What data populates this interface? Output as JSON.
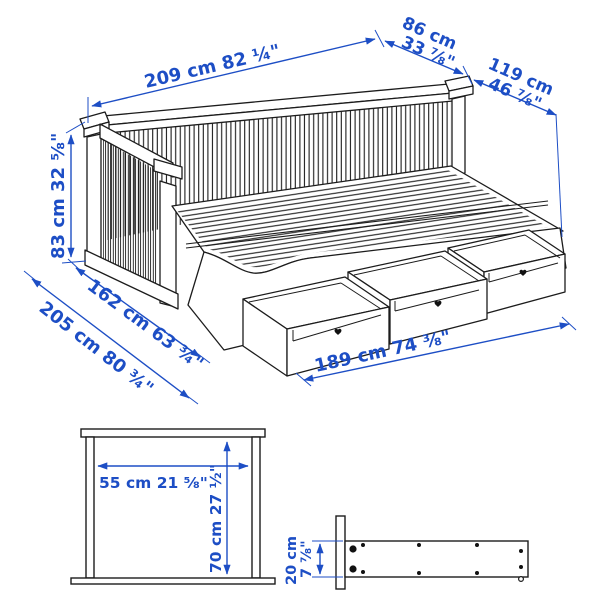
{
  "colors": {
    "dimension_blue": "#1d4ec5",
    "line_art": "#1c1c1c",
    "background": "#ffffff"
  },
  "main_view": {
    "length_label": "209 cm 82 ¼\"",
    "arm_depth_cm": "86 cm",
    "arm_depth_in": "33 ⅞\"",
    "extended_depth_cm": "119 cm",
    "extended_depth_in": "46 ⅞\"",
    "height_label": "83 cm 32 ⅝\"",
    "width_single_label": "162 cm 63 ¾\"",
    "width_extended_label": "205 cm 80 ¾\"",
    "drawer_span_label": "189 cm 74 ⅜\""
  },
  "frame_front_view": {
    "inner_width_label": "55 cm 21 ⅝\"",
    "inner_height_label": "70 cm 27 ½\""
  },
  "rail_side_view": {
    "height_cm": "20 cm",
    "height_in": "7 ⅞\""
  }
}
